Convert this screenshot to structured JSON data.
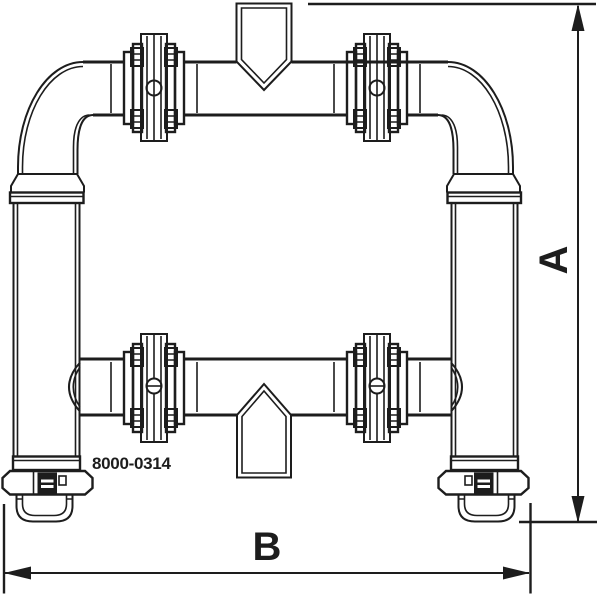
{
  "figure": {
    "part_number": "8000-0314",
    "dimension_vertical_label": "A",
    "dimension_horizontal_label": "B",
    "line_color": "#1d1d1d",
    "background_color": "#ffffff"
  }
}
